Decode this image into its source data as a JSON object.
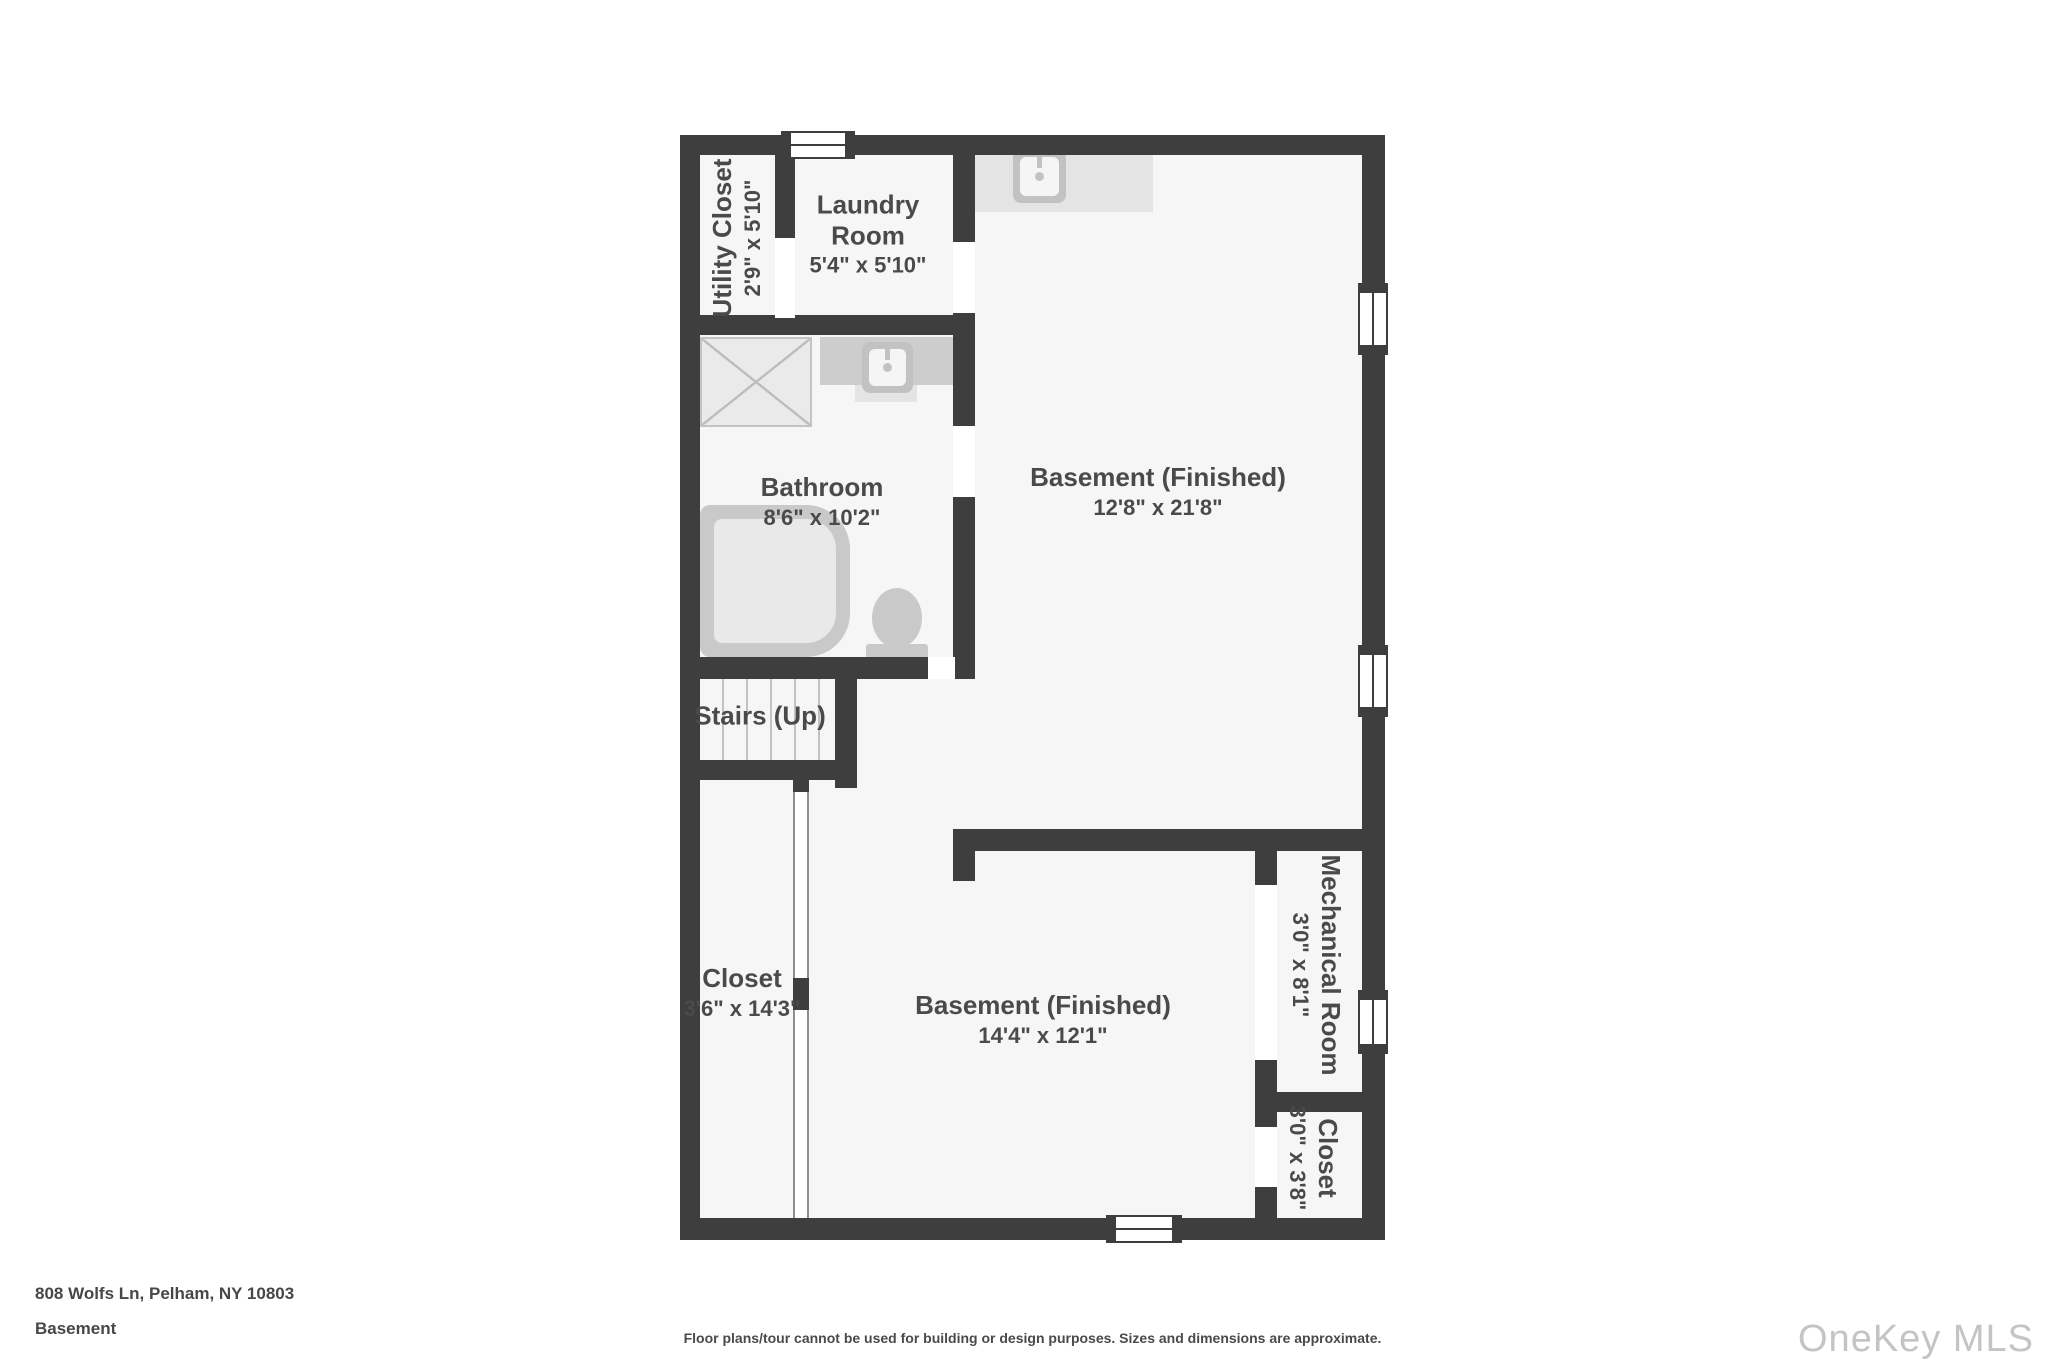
{
  "rooms": {
    "utility": {
      "name": "Utility Closet",
      "dims": "2'9\" x 5'10\""
    },
    "laundry": {
      "name": "Laundry Room",
      "dims": "5'4\" x 5'10\""
    },
    "basement_upper": {
      "name": "Basement (Finished)",
      "dims": "12'8\" x 21'8\""
    },
    "bathroom": {
      "name": "Bathroom",
      "dims": "8'6\" x 10'2\""
    },
    "stairs": {
      "name": "Stairs (Up)"
    },
    "closet_left": {
      "name": "Closet",
      "dims": "3'6\" x 14'3\""
    },
    "basement_lower": {
      "name": "Basement (Finished)",
      "dims": "14'4\" x 12'1\""
    },
    "mechanical": {
      "name": "Mechanical Room",
      "dims": "3'0\" x 8'1\""
    },
    "closet_br": {
      "name": "Closet",
      "dims": "3'0\" x 3'8\""
    }
  },
  "footer": {
    "address": "808 Wolfs Ln, Pelham, NY 10803",
    "level": "Basement",
    "disclaimer": "Floor plans/tour cannot be used for building or design purposes. Sizes and dimensions are approximate.",
    "watermark": "OneKey MLS"
  },
  "icons": [
    "sink-icon",
    "bathtub-icon",
    "toilet-icon",
    "shower-pan-icon",
    "stairs-icon",
    "window-icon",
    "door-opening"
  ],
  "colors": {
    "wall": "#3e3e3e",
    "room_fill": "#f6f6f6",
    "fixture_gray": "#c9c9c9",
    "counter_gray": "#e4e4e4",
    "text": "#4a4a4a",
    "watermark": "#c4c4c7"
  }
}
